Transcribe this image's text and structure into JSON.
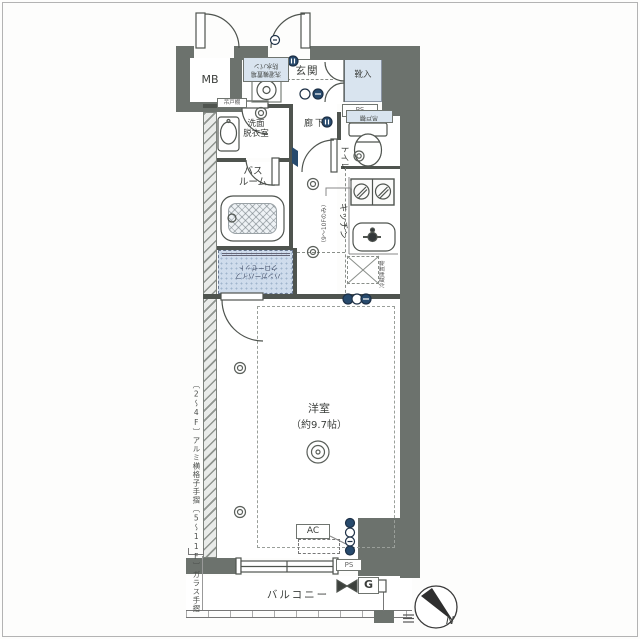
{
  "colors": {
    "wall": "#6c726d",
    "line": "#4f544f",
    "wet_area": "#d9e4ef",
    "symbol_blue": "#274a6d",
    "dash": "#8a8f8a"
  },
  "rooms": {
    "mb": "MB",
    "genkan": "玄関",
    "shoe_cabinet": "靴入",
    "pipe_space_top": "PS",
    "washroom": [
      "洗面",
      "脱衣室"
    ],
    "hallway": "廊下",
    "toilet": "トイレ",
    "bathroom": [
      "バス",
      "ルーム"
    ],
    "kitchen": "キッチン",
    "kitchen_note": "（9〜10Fのみ）",
    "main_room": [
      "洋室",
      "（約9.7帖）"
    ],
    "balcony": "バルコニー",
    "pipe_space_bottom": "PS",
    "gas_meter": "G",
    "air_conditioner": "AC"
  },
  "fixtures": {
    "washer": [
      "洗濯機置場",
      "防水パン"
    ],
    "closet": [
      "ハンガーパイプ",
      "クローゼット"
    ],
    "toilet_cupboard": "吊戸棚",
    "washroom_cupboard": "吊戸棚",
    "fridge": "冷蔵庫置場"
  },
  "notes": {
    "handrail_low": "〔2〜4F〕アルミ横格子手摺",
    "handrail_high": "〔5〜11F〕ガラス手摺",
    "compass_north": "N"
  }
}
